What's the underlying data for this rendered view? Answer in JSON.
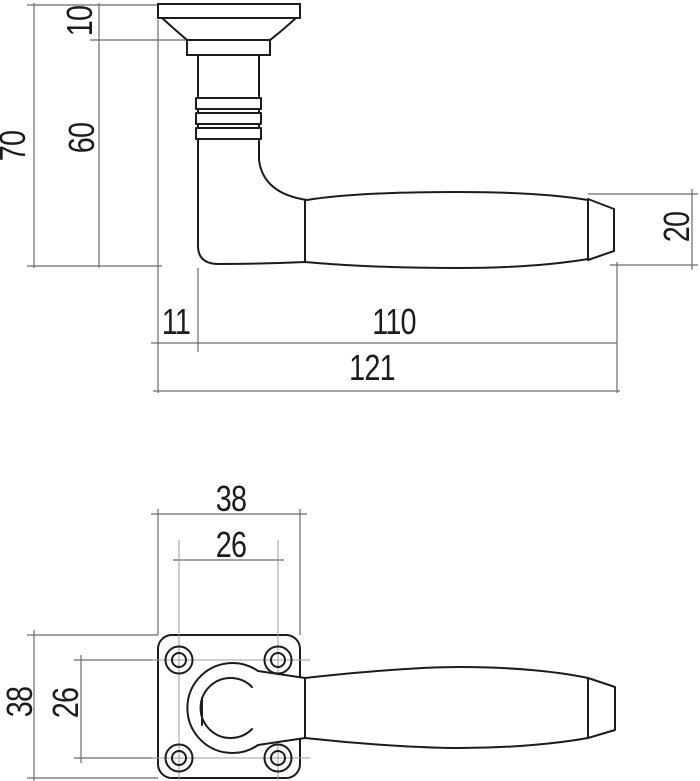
{
  "title": "Door handle dimension drawing",
  "units": "mm",
  "colors": {
    "background": "#ffffff",
    "outline": "#1c1c1c",
    "dimension": "#6b6b6b",
    "centerline": "#9c9c9c",
    "text": "#1d1d1d"
  },
  "side_view": {
    "dims": {
      "overall_height": "70",
      "stem_height": "60",
      "rose_cap_height": "10",
      "rose_offset": "11",
      "lever_length": "110",
      "overall_length": "121",
      "grip_end_diameter": "20"
    }
  },
  "front_view": {
    "dims": {
      "rose_width": "38",
      "screw_spacing_horizontal": "26",
      "rose_height": "38",
      "screw_spacing_vertical": "26"
    }
  }
}
